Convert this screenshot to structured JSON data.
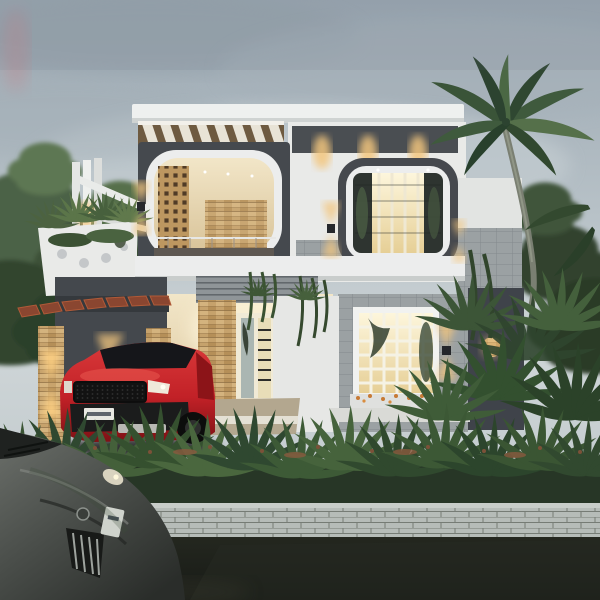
{
  "scene": {
    "type": "3d-architectural-render",
    "description": "Dusk exterior rendering of a modern two-storey contemporary house with warm interior lighting. Upper floor has a pergola-topped balcony with a wooden lattice screen inside a dark rounded frame, and a rounded-square picture window. Ground floor has a carport with a red Range Rover style SUV, stone-clad pillars with sconces, a tall stair window, and a grid window with a flower box. Tropical landscaping: palm tree, hedges, vines. A dark grey sedan sits in the foreground street by a low white brick boundary wall.",
    "time_of_day": "dusk",
    "lighting": "warm interior glow against overcast blue-grey sky"
  },
  "palette": {
    "sky_top": "#9fabb4",
    "sky_mid": "#bcc6cc",
    "sky_low": "#ced5d7",
    "charcoal": "#45494e",
    "white_wall": "#e9eae8",
    "warm_glow": "#ffd9a0",
    "window_glow": "#f6ecc6",
    "wood_slat": "#c0985f",
    "stone_clad": "#c4a06a",
    "tile_grey": "#9ba1a3",
    "foliage_dark": "#2e4029",
    "foliage_mid": "#45603b",
    "foliage_light": "#5f7b4e",
    "suv_red": "#c22127",
    "sedan_grey": "#4a4e4b",
    "road": "#1d201d",
    "brick_wall": "#b6bcb8",
    "carport_pergola_wood": "#8a4630"
  },
  "objects": [
    {
      "name": "sky",
      "note": "overcast dusk sky, faint pink smudge top-left"
    },
    {
      "name": "left-trees",
      "note": "soft green trees behind house, left side"
    },
    {
      "name": "palm-tree",
      "note": "tall coconut palm right of house, curved trunk"
    },
    {
      "name": "pergola-slats",
      "note": "wooden roof slats over balcony"
    },
    {
      "name": "balcony-frame",
      "note": "dark rounded frame, white arch, lattice jali screen, glass rail"
    },
    {
      "name": "upper-window",
      "note": "rounded-square dark frame, warm lit vertical mullions"
    },
    {
      "name": "soffit-downlights",
      "note": "three warm downlights in roof band"
    },
    {
      "name": "wall-sconces",
      "note": "up/down warm sconces on frames, pillars and walls"
    },
    {
      "name": "planter-box",
      "note": "white perforated planter with trailing plants"
    },
    {
      "name": "louver-band",
      "note": "grey horizontal louvres over entry"
    },
    {
      "name": "stair-window",
      "note": "tall double window with staircase silhouette"
    },
    {
      "name": "ground-window",
      "note": "white grid window, warm lit, flower box below"
    },
    {
      "name": "feature-panel",
      "note": "dark panel with circular cutouts, right side"
    },
    {
      "name": "carport",
      "note": "charcoal wall, red-wood slats, stone pillars"
    },
    {
      "name": "red-suv",
      "note": "red compact luxury SUV parked in carport, license plate illegible"
    },
    {
      "name": "hedge",
      "note": "dense spiky shrub row with rusty flower tips"
    },
    {
      "name": "boundary-wall",
      "note": "low white brick wall along street"
    },
    {
      "name": "road",
      "note": "dark asphalt street"
    },
    {
      "name": "foreground-sedan",
      "note": "dark grey sedan nose, chrome grille, parked in street"
    }
  ]
}
